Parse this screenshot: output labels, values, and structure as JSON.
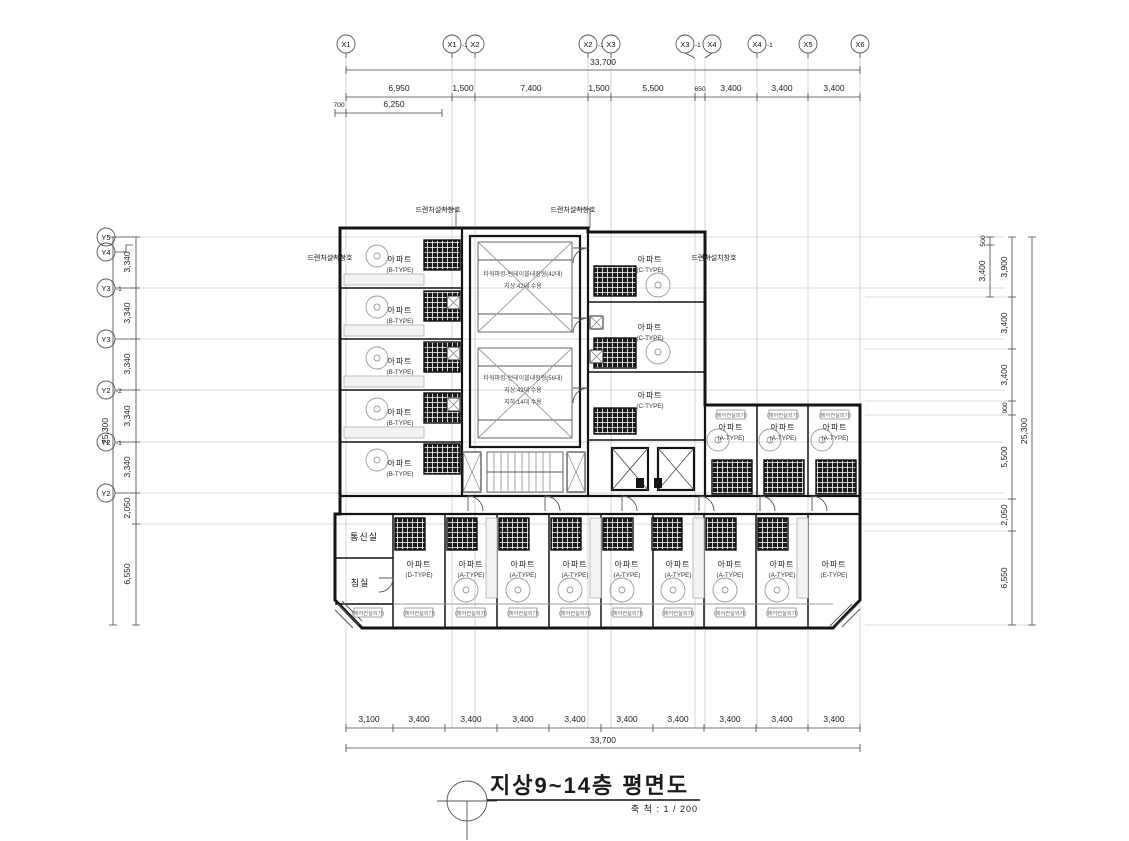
{
  "title": {
    "text": "지상9~14층 평면도",
    "scale": "축 척 : 1 / 200"
  },
  "axes": {
    "x": [
      {
        "main": "X1",
        "suffix": ""
      },
      {
        "main": "X1",
        "suffix": "-1"
      },
      {
        "main": "X2",
        "suffix": ""
      },
      {
        "main": "X2",
        "suffix": "-1"
      },
      {
        "main": "X3",
        "suffix": ""
      },
      {
        "main": "X3",
        "suffix": "-1"
      },
      {
        "main": "X4",
        "suffix": ""
      },
      {
        "main": "X4",
        "suffix": "-1"
      },
      {
        "main": "X5",
        "suffix": ""
      },
      {
        "main": "X6",
        "suffix": ""
      }
    ],
    "y": [
      {
        "main": "Y5",
        "suffix": ""
      },
      {
        "main": "Y4",
        "suffix": ""
      },
      {
        "main": "Y3",
        "suffix": "-1"
      },
      {
        "main": "Y3",
        "suffix": ""
      },
      {
        "main": "Y2",
        "suffix": "-2"
      },
      {
        "main": "Y2",
        "suffix": "-1"
      },
      {
        "main": "Y2",
        "suffix": ""
      }
    ]
  },
  "dims": {
    "top": {
      "total": "33,700",
      "segments": [
        "6,950",
        "1,500",
        "7,400",
        "1,500",
        "5,500",
        "650",
        "3,400",
        "3,400",
        "3,400"
      ],
      "sub": [
        "700",
        "6,250"
      ]
    },
    "bottom": {
      "total": "33,700",
      "segments": [
        "3,100",
        "3,400",
        "3,400",
        "3,400",
        "3,400",
        "3,400",
        "3,400",
        "3,400",
        "3,400",
        "3,400"
      ]
    },
    "left": {
      "total": "25,300",
      "segments": [
        "3,340",
        "3,340",
        "3,340",
        "3,340",
        "3,340",
        "2,050",
        "6,550"
      ]
    },
    "right": {
      "total": "25,300",
      "inner": [
        "500",
        "3,400"
      ],
      "segments": [
        "3,900",
        "3,400",
        "3,400",
        "900",
        "5,500",
        "2,050",
        "6,550"
      ]
    }
  },
  "rooms": {
    "comm_room": "통신실",
    "bedroom": "침실",
    "left_units": [
      {
        "label": "아파트",
        "type": "(B-TYPE)"
      },
      {
        "label": "아파트",
        "type": "(B-TYPE)"
      },
      {
        "label": "아파트",
        "type": "(B-TYPE)"
      },
      {
        "label": "아파트",
        "type": "(B-TYPE)"
      },
      {
        "label": "아파트",
        "type": "(B-TYPE)"
      }
    ],
    "right_units": [
      {
        "label": "아파트",
        "type": "(C-TYPE)"
      },
      {
        "label": "아파트",
        "type": "(C-TYPE)"
      },
      {
        "label": "아파트",
        "type": "(C-TYPE)"
      }
    ],
    "east_units": [
      {
        "label": "아파트",
        "type": "(A-TYPE)"
      },
      {
        "label": "아파트",
        "type": "(A-TYPE)"
      },
      {
        "label": "아파트",
        "type": "(A-TYPE)"
      }
    ],
    "bottom_units": [
      {
        "label": "아파트",
        "type": "(D-TYPE)"
      },
      {
        "label": "아파트",
        "type": "(A-TYPE)"
      },
      {
        "label": "아파트",
        "type": "(A-TYPE)"
      },
      {
        "label": "아파트",
        "type": "(A-TYPE)"
      },
      {
        "label": "아파트",
        "type": "(A-TYPE)"
      },
      {
        "label": "아파트",
        "type": "(A-TYPE)"
      },
      {
        "label": "아파트",
        "type": "(A-TYPE)"
      },
      {
        "label": "아파트",
        "type": "(A-TYPE)"
      },
      {
        "label": "아파트",
        "type": "(E-TYPE)"
      }
    ]
  },
  "annotations": {
    "drencher": "드렌처설치창호",
    "parking_upper": [
      "타워파킹-턴테이블내장형(42대)",
      "지상:42대 수용"
    ],
    "parking_lower": [
      "타워파킹-턴테이블내장형(56대)",
      "지상:42대 수용",
      "지하:14대 수용"
    ],
    "ac_unit": "(에어컨실외기)"
  }
}
